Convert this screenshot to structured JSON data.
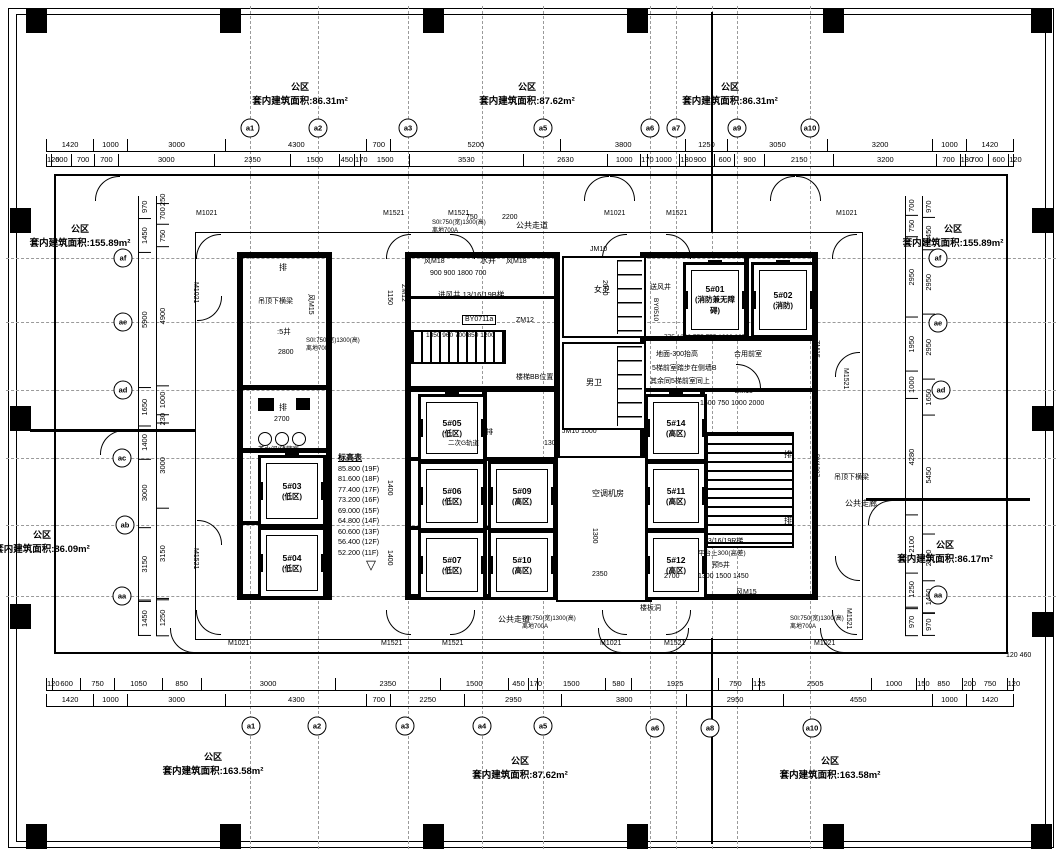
{
  "colors": {
    "ink": "#000000",
    "paper": "#ffffff"
  },
  "areas": [
    {
      "t": "公区",
      "a": "套内建筑面积:86.31m²",
      "x": 300,
      "y": 80
    },
    {
      "t": "公区",
      "a": "套内建筑面积:87.62m²",
      "x": 527,
      "y": 80
    },
    {
      "t": "公区",
      "a": "套内建筑面积:86.31m²",
      "x": 730,
      "y": 80
    },
    {
      "t": "公区",
      "a": "套内建筑面积:155.89m²",
      "x": 80,
      "y": 222
    },
    {
      "t": "公区",
      "a": "套内建筑面积:155.89m²",
      "x": 953,
      "y": 222
    },
    {
      "t": "公区",
      "a": "套内建筑面积:86.09m²",
      "x": 42,
      "y": 528
    },
    {
      "t": "公区",
      "a": "套内建筑面积:86.17m²",
      "x": 945,
      "y": 538
    },
    {
      "t": "公区",
      "a": "套内建筑面积:163.58m²",
      "x": 213,
      "y": 750
    },
    {
      "t": "公区",
      "a": "套内建筑面积:87.62m²",
      "x": 520,
      "y": 754
    },
    {
      "t": "公区",
      "a": "套内建筑面积:163.58m²",
      "x": 830,
      "y": 754
    }
  ],
  "bubbles": [
    {
      "l": "a1",
      "x": 250,
      "y": 128
    },
    {
      "l": "a2",
      "x": 318,
      "y": 128
    },
    {
      "l": "a3",
      "x": 408,
      "y": 128
    },
    {
      "l": "a5",
      "x": 543,
      "y": 128
    },
    {
      "l": "a6",
      "x": 650,
      "y": 128
    },
    {
      "l": "a7",
      "x": 676,
      "y": 128
    },
    {
      "l": "a9",
      "x": 737,
      "y": 128
    },
    {
      "l": "a10",
      "x": 810,
      "y": 128
    },
    {
      "l": "a1",
      "x": 251,
      "y": 726
    },
    {
      "l": "a2",
      "x": 317,
      "y": 726
    },
    {
      "l": "a3",
      "x": 405,
      "y": 726
    },
    {
      "l": "a4",
      "x": 482,
      "y": 726
    },
    {
      "l": "a5",
      "x": 543,
      "y": 726
    },
    {
      "l": "a6",
      "x": 655,
      "y": 728
    },
    {
      "l": "a8",
      "x": 710,
      "y": 728
    },
    {
      "l": "a10",
      "x": 812,
      "y": 728
    },
    {
      "l": "af",
      "x": 123,
      "y": 258
    },
    {
      "l": "ae",
      "x": 123,
      "y": 322
    },
    {
      "l": "ad",
      "x": 123,
      "y": 390
    },
    {
      "l": "ac",
      "x": 122,
      "y": 458
    },
    {
      "l": "ab",
      "x": 125,
      "y": 525
    },
    {
      "l": "aa",
      "x": 122,
      "y": 596
    },
    {
      "l": "af",
      "x": 938,
      "y": 258
    },
    {
      "l": "ae",
      "x": 938,
      "y": 323
    },
    {
      "l": "ad",
      "x": 941,
      "y": 390
    },
    {
      "l": "aa",
      "x": 938,
      "y": 595
    }
  ],
  "columns": [
    {
      "x": 26,
      "y": 8
    },
    {
      "x": 220,
      "y": 8
    },
    {
      "x": 423,
      "y": 8
    },
    {
      "x": 627,
      "y": 8
    },
    {
      "x": 823,
      "y": 8
    },
    {
      "x": 1031,
      "y": 8
    },
    {
      "x": 26,
      "y": 824
    },
    {
      "x": 220,
      "y": 824
    },
    {
      "x": 423,
      "y": 824
    },
    {
      "x": 627,
      "y": 824
    },
    {
      "x": 823,
      "y": 824
    },
    {
      "x": 1031,
      "y": 824
    },
    {
      "x": 10,
      "y": 208
    },
    {
      "x": 10,
      "y": 406
    },
    {
      "x": 10,
      "y": 604
    },
    {
      "x": 1032,
      "y": 208
    },
    {
      "x": 1032,
      "y": 406
    },
    {
      "x": 1032,
      "y": 612
    }
  ],
  "elevators": [
    {
      "n": "5#01",
      "z": "(消防兼无障碍)",
      "x": 683,
      "y": 262,
      "w": 58,
      "h": 70
    },
    {
      "n": "5#02",
      "z": "(消防)",
      "x": 751,
      "y": 262,
      "w": 58,
      "h": 70
    },
    {
      "n": "5#03",
      "z": "(低区)",
      "x": 258,
      "y": 455,
      "w": 62,
      "h": 66
    },
    {
      "n": "5#04",
      "z": "(低区)",
      "x": 258,
      "y": 527,
      "w": 62,
      "h": 66
    },
    {
      "n": "5#05",
      "z": "(低区)",
      "x": 418,
      "y": 394,
      "w": 62,
      "h": 62
    },
    {
      "n": "5#06",
      "z": "(低区)",
      "x": 418,
      "y": 461,
      "w": 62,
      "h": 64
    },
    {
      "n": "5#07",
      "z": "(低区)",
      "x": 418,
      "y": 530,
      "w": 62,
      "h": 64
    },
    {
      "n": "5#09",
      "z": "(高区)",
      "x": 488,
      "y": 461,
      "w": 62,
      "h": 64
    },
    {
      "n": "5#10",
      "z": "(高区)",
      "x": 488,
      "y": 530,
      "w": 62,
      "h": 64
    },
    {
      "n": "5#14",
      "z": "(高区)",
      "x": 645,
      "y": 394,
      "w": 56,
      "h": 62
    },
    {
      "n": "5#11",
      "z": "(高区)",
      "x": 645,
      "y": 461,
      "w": 56,
      "h": 64
    },
    {
      "n": "5#12",
      "z": "(高区)",
      "x": 645,
      "y": 530,
      "w": 56,
      "h": 64
    }
  ],
  "floors": {
    "title": "标高表",
    "rows": [
      "85.800 (19F)",
      "81.600 (18F)",
      "77.400 (17F)",
      "73.200 (16F)",
      "69.000 (15F)",
      "64.800 (14F)",
      "60.600 (13F)",
      "56.400 (12F)",
      "52.200 (11F)"
    ],
    "arrow": "▽"
  },
  "chains": {
    "top_outer": [
      "1420",
      "1000",
      "3000",
      "4300",
      "700",
      "5200",
      "3800",
      "1250",
      "3050",
      "3200",
      "1000",
      "1420"
    ],
    "top_inner": [
      "120",
      "600",
      "700",
      "700",
      "3000",
      "2350",
      "1500",
      "450",
      "170",
      "1500",
      "3530",
      "2630",
      "1000",
      "170",
      "1000",
      "130",
      "900",
      "600",
      "900",
      "2150",
      "3200",
      "700",
      "130",
      "700",
      "600",
      "120"
    ],
    "bottom_inner": [
      "120",
      "600",
      "750",
      "1050",
      "850",
      "3000",
      "2350",
      "1500",
      "450",
      "170",
      "1500",
      "580",
      "1925",
      "750",
      "125",
      "2505",
      "1000",
      "150",
      "850",
      "200",
      "750",
      "120"
    ],
    "bottom_outer": [
      "1420",
      "1000",
      "3000",
      "4300",
      "700",
      "2250",
      "2950",
      "3800",
      "2950",
      "4550",
      "1000",
      "1420"
    ],
    "left_outer": [
      "970",
      "1450",
      "5900",
      "1650",
      "1400",
      "3000",
      "3150",
      "1450"
    ],
    "left_inner": [
      "250",
      "700",
      "750",
      "4900",
      "1000",
      "230",
      "3000",
      "3150",
      "1250"
    ],
    "right_outer": [
      "970",
      "1450",
      "2950",
      "2950",
      "1650",
      "5450",
      "2100",
      "1450",
      "970"
    ],
    "right_inner": [
      "700",
      "750",
      "2950",
      "1950",
      "1000",
      "4280",
      "2100",
      "1250",
      "970"
    ]
  },
  "notes": [
    {
      "t": "M1021",
      "x": 196,
      "y": 210,
      "s": 7
    },
    {
      "t": "M1521",
      "x": 383,
      "y": 210,
      "s": 7
    },
    {
      "t": "M1521",
      "x": 448,
      "y": 210,
      "s": 7
    },
    {
      "t": "M1021",
      "x": 604,
      "y": 210,
      "s": 7
    },
    {
      "t": "M1521",
      "x": 666,
      "y": 210,
      "s": 7
    },
    {
      "t": "M1021",
      "x": 836,
      "y": 210,
      "s": 7
    },
    {
      "t": "M1021",
      "x": 228,
      "y": 640,
      "s": 7
    },
    {
      "t": "M1521",
      "x": 381,
      "y": 640,
      "s": 7
    },
    {
      "t": "M1521",
      "x": 442,
      "y": 640,
      "s": 7
    },
    {
      "t": "M1021",
      "x": 600,
      "y": 640,
      "s": 7
    },
    {
      "t": "M1521",
      "x": 664,
      "y": 640,
      "s": 7
    },
    {
      "t": "M1021",
      "x": 814,
      "y": 640,
      "s": 7
    },
    {
      "t": "M1021",
      "x": 199,
      "y": 282,
      "r": 90,
      "s": 7
    },
    {
      "t": "M1521",
      "x": 199,
      "y": 548,
      "r": 90,
      "s": 7
    },
    {
      "t": "M1521",
      "x": 849,
      "y": 368,
      "r": 90,
      "s": 7
    },
    {
      "t": "M1521",
      "x": 852,
      "y": 608,
      "r": 90,
      "s": 7
    },
    {
      "t": "750",
      "x": 466,
      "y": 214,
      "s": 7
    },
    {
      "t": "2200",
      "x": 502,
      "y": 214,
      "s": 7
    },
    {
      "t": "S0l:750(宽)1300(高)",
      "x": 306,
      "y": 338,
      "s": 6
    },
    {
      "t": "离地700A",
      "x": 306,
      "y": 346,
      "s": 6
    },
    {
      "t": "S0l:750(宽)1300(高)",
      "x": 432,
      "y": 220,
      "s": 6
    },
    {
      "t": "离地700A",
      "x": 432,
      "y": 228,
      "s": 6
    },
    {
      "t": "S0l:750(宽)1300(高)",
      "x": 522,
      "y": 616,
      "s": 6
    },
    {
      "t": "离地700A",
      "x": 522,
      "y": 624,
      "s": 6
    },
    {
      "t": "S0l:750(宽)1300(高)",
      "x": 790,
      "y": 616,
      "s": 6
    },
    {
      "t": "离地700A",
      "x": 790,
      "y": 624,
      "s": 6
    },
    {
      "t": "公共走道",
      "x": 516,
      "y": 222,
      "s": 8
    },
    {
      "t": "公共走道",
      "x": 498,
      "y": 616,
      "s": 8
    },
    {
      "t": "公共走廊",
      "x": 845,
      "y": 500,
      "s": 8
    },
    {
      "t": "水井",
      "x": 480,
      "y": 257,
      "s": 8
    },
    {
      "t": "风M18",
      "x": 424,
      "y": 258,
      "s": 7
    },
    {
      "t": "风M18",
      "x": 506,
      "y": 258,
      "s": 7
    },
    {
      "t": "900  900  1800  700",
      "x": 430,
      "y": 270,
      "s": 7
    },
    {
      "t": "进风井 13/16/19B梯",
      "x": 438,
      "y": 291,
      "s": 7.5
    },
    {
      "t": "BY0711a",
      "x": 462,
      "y": 315,
      "s": 7,
      "box": true
    },
    {
      "t": "ZM12",
      "x": 516,
      "y": 317,
      "s": 7
    },
    {
      "t": "ZM12",
      "x": 407,
      "y": 284,
      "r": 90,
      "s": 7
    },
    {
      "t": "风M15",
      "x": 314,
      "y": 294,
      "r": 90,
      "s": 7
    },
    {
      "t": "女卫",
      "x": 594,
      "y": 286,
      "s": 8
    },
    {
      "t": "男卫",
      "x": 586,
      "y": 379,
      "s": 8
    },
    {
      "t": "2000",
      "x": 608,
      "y": 280,
      "r": 90,
      "s": 7
    },
    {
      "t": "1850  960 700 850  1200",
      "x": 426,
      "y": 332,
      "s": 6.5
    },
    {
      "t": "楼梯BB位置",
      "x": 516,
      "y": 374,
      "s": 7
    },
    {
      "t": "JM10",
      "x": 590,
      "y": 246,
      "s": 7
    },
    {
      "t": "JM10 1000",
      "x": 562,
      "y": 428,
      "s": 7
    },
    {
      "t": "1300",
      "x": 544,
      "y": 440,
      "s": 7
    },
    {
      "t": "空调机房",
      "x": 592,
      "y": 490,
      "s": 8
    },
    {
      "t": "1300",
      "x": 598,
      "y": 528,
      "r": 90,
      "s": 7
    },
    {
      "t": "2350",
      "x": 592,
      "y": 571,
      "s": 7
    },
    {
      "t": "楼板洞",
      "x": 640,
      "y": 605,
      "s": 7
    },
    {
      "t": "排",
      "x": 279,
      "y": 264,
      "s": 8
    },
    {
      "t": "排",
      "x": 279,
      "y": 404,
      "s": 8
    },
    {
      "t": "排",
      "x": 486,
      "y": 429,
      "s": 7
    },
    {
      "t": "排",
      "x": 784,
      "y": 451,
      "s": 8
    },
    {
      "t": "排",
      "x": 784,
      "y": 517,
      "s": 8
    },
    {
      "t": "吊顶下横梁",
      "x": 258,
      "y": 298,
      "s": 7
    },
    {
      "t": ":5井",
      "x": 277,
      "y": 328,
      "s": 7.5
    },
    {
      "t": "2800",
      "x": 278,
      "y": 349,
      "s": 7
    },
    {
      "t": "2700",
      "x": 274,
      "y": 416,
      "s": 7
    },
    {
      "t": "茶水间/储藏室",
      "x": 258,
      "y": 446,
      "s": 6.5
    },
    {
      "t": "二次G轨道",
      "x": 448,
      "y": 440,
      "s": 6.5
    },
    {
      "t": "送风井",
      "x": 650,
      "y": 284,
      "s": 7
    },
    {
      "t": "BY0510",
      "x": 659,
      "y": 298,
      "r": 90,
      "s": 6.5
    },
    {
      "t": "775 1300 775  775 1300 825",
      "x": 664,
      "y": 334,
      "s": 6.5
    },
    {
      "t": "地面-300抬高",
      "x": 656,
      "y": 351,
      "s": 7
    },
    {
      "t": "合用前室",
      "x": 734,
      "y": 351,
      "s": 7
    },
    {
      "t": "5梯前室踏步在侧墙B",
      "x": 652,
      "y": 365,
      "s": 7
    },
    {
      "t": "其余同5梯前室同上",
      "x": 650,
      "y": 378,
      "s": 7
    },
    {
      "t": "ZM15",
      "x": 735,
      "y": 388,
      "s": 7
    },
    {
      "t": "ZM15",
      "x": 820,
      "y": 340,
      "r": 90,
      "s": 7
    },
    {
      "t": "1500  750 1000  2000",
      "x": 700,
      "y": 400,
      "s": 7
    },
    {
      "t": "13/16/19R梯",
      "x": 704,
      "y": 538,
      "s": 7
    },
    {
      "t": "平台上300(高差)",
      "x": 698,
      "y": 550,
      "s": 6.5
    },
    {
      "t": "预5井",
      "x": 712,
      "y": 562,
      "s": 7
    },
    {
      "t": "1300  1500  1450",
      "x": 698,
      "y": 573,
      "s": 7
    },
    {
      "t": "2700",
      "x": 664,
      "y": 573,
      "s": 7
    },
    {
      "t": "风M15",
      "x": 736,
      "y": 589,
      "s": 7
    },
    {
      "t": "吊顶下横梁",
      "x": 834,
      "y": 474,
      "s": 7
    },
    {
      "t": "BY1207",
      "x": 820,
      "y": 454,
      "r": 90,
      "s": 6.5
    },
    {
      "t": "1400",
      "x": 393,
      "y": 480,
      "r": 90,
      "s": 7
    },
    {
      "t": "1400",
      "x": 393,
      "y": 550,
      "r": 90,
      "s": 7
    },
    {
      "t": "1150",
      "x": 393,
      "y": 290,
      "r": 90,
      "s": 7
    },
    {
      "t": "120  460",
      "x": 1006,
      "y": 652,
      "s": 7
    }
  ],
  "arcs": [
    {
      "x": 196,
      "y": 234,
      "r": 0
    },
    {
      "x": 386,
      "y": 234,
      "r": 0
    },
    {
      "x": 450,
      "y": 234,
      "r": 90
    },
    {
      "x": 602,
      "y": 234,
      "r": 0
    },
    {
      "x": 666,
      "y": 234,
      "r": 90
    },
    {
      "x": 832,
      "y": 234,
      "r": 0
    },
    {
      "x": 196,
      "y": 610,
      "r": 270
    },
    {
      "x": 386,
      "y": 610,
      "r": 270
    },
    {
      "x": 450,
      "y": 610,
      "r": 180
    },
    {
      "x": 602,
      "y": 610,
      "r": 270
    },
    {
      "x": 666,
      "y": 610,
      "r": 180
    },
    {
      "x": 832,
      "y": 610,
      "r": 270
    },
    {
      "x": 197,
      "y": 296,
      "r": 180
    },
    {
      "x": 197,
      "y": 520,
      "r": 90
    },
    {
      "x": 835,
      "y": 352,
      "r": 0
    },
    {
      "x": 835,
      "y": 556,
      "r": 270
    },
    {
      "x": 95,
      "y": 176,
      "r": 0
    },
    {
      "x": 584,
      "y": 176,
      "r": 0
    },
    {
      "x": 610,
      "y": 176,
      "r": 90
    },
    {
      "x": 770,
      "y": 176,
      "r": 0
    },
    {
      "x": 796,
      "y": 176,
      "r": 90
    },
    {
      "x": 170,
      "y": 628,
      "r": 270
    },
    {
      "x": 598,
      "y": 628,
      "r": 270
    },
    {
      "x": 664,
      "y": 628,
      "r": 180
    },
    {
      "x": 820,
      "y": 628,
      "r": 270
    },
    {
      "x": 100,
      "y": 430,
      "r": 0
    },
    {
      "x": 868,
      "y": 500,
      "r": 0
    },
    {
      "x": 736,
      "y": 364,
      "r": 90
    }
  ]
}
